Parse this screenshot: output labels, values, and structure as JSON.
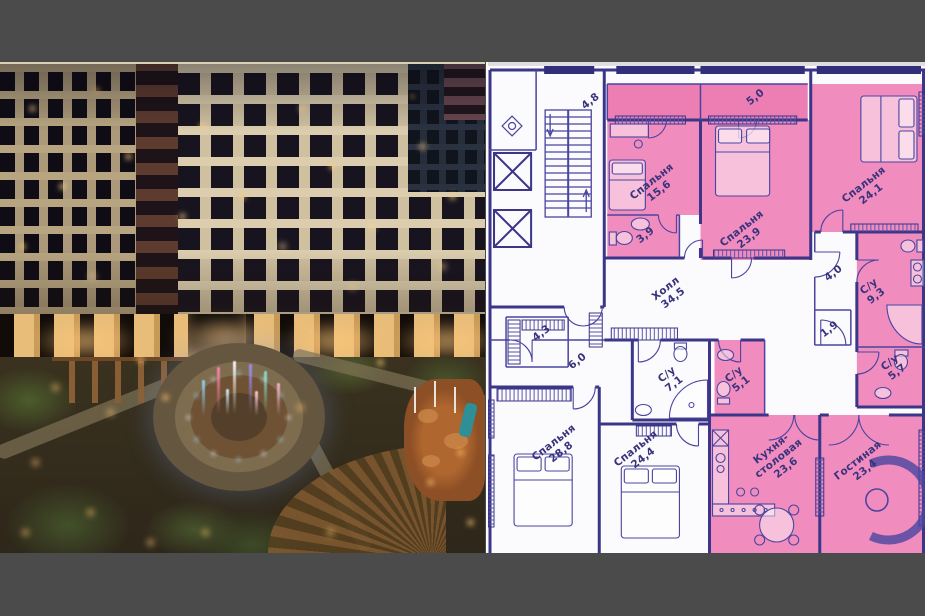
{
  "canvas": {
    "width": 925,
    "height": 616,
    "background": "#4b4b4b"
  },
  "photo_panel": {
    "colors": {
      "facade": "#d9cbab",
      "brick_tower": "#5e3b2f",
      "windows_dark": "#17131f",
      "windows_lit": "#ffd089",
      "greenery": "#45522a",
      "fountain_blue": "#8fd6ff",
      "fountain_pink": "#ff85b5"
    }
  },
  "floor_plan": {
    "background": "#fbfbfd",
    "line_color": "#3b3688",
    "highlight_color": "#f18cbe",
    "rooms": [
      {
        "label": "Спальня",
        "area": "15,6",
        "highlighted": true
      },
      {
        "label": "Спальня",
        "area": "23,9",
        "highlighted": true
      },
      {
        "label": "Спальня",
        "area": "24,1",
        "highlighted": true
      },
      {
        "label": "",
        "area": "3,9",
        "highlighted": true
      },
      {
        "label": "Холл",
        "area": "34,5",
        "highlighted": false
      },
      {
        "label": "С/у",
        "area": "9,3",
        "highlighted": true
      },
      {
        "label": "",
        "area": "4,0",
        "highlighted": false
      },
      {
        "label": "",
        "area": "1,9",
        "highlighted": false
      },
      {
        "label": "С/у",
        "area": "5,7",
        "highlighted": true
      },
      {
        "label": "С/у",
        "area": "5,1",
        "highlighted": true
      },
      {
        "label": "С/у",
        "area": "7,1",
        "highlighted": false
      },
      {
        "label": "",
        "area": "6,0",
        "highlighted": false
      },
      {
        "label": "",
        "area": "4,3",
        "highlighted": false
      },
      {
        "label": "Спальня",
        "area": "28,8",
        "highlighted": false
      },
      {
        "label": "Спальня",
        "area": "24,4",
        "highlighted": false
      },
      {
        "label": "Кухня-столовая",
        "area": "23,6",
        "highlighted": true
      },
      {
        "label": "Гостиная",
        "area": "23,4",
        "highlighted": true
      },
      {
        "label": "",
        "area": "4,8",
        "highlighted": true
      },
      {
        "label": "",
        "area": "5,0",
        "highlighted": true
      }
    ]
  }
}
